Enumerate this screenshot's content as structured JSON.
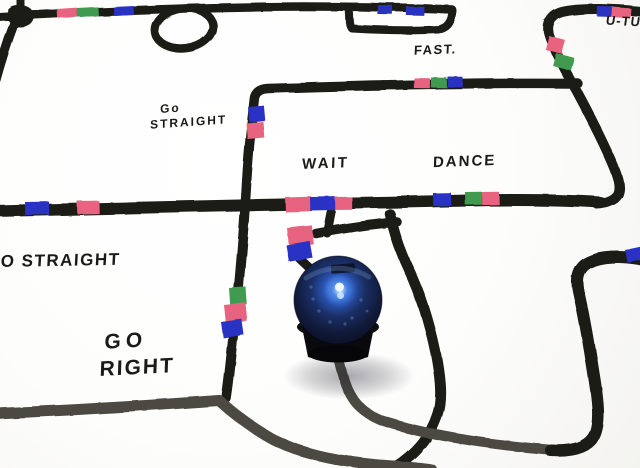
{
  "labels": {
    "go_straight_top_line1": "Go",
    "go_straight_top_line2": "STRAIGHT",
    "fast": "FAST.",
    "u_turn": "U-TURN",
    "wait": "WAIT",
    "dance": "DANCE",
    "go_straight_left": "GO STRAIGHT",
    "go_right_line1": "GO",
    "go_right_line2": "RIGHT"
  },
  "colors": {
    "code_pink": "#e7647f",
    "code_blue": "#2a33c4",
    "code_green": "#419a4f",
    "line_black": "#1b1a18",
    "line_gray": "#4c4a42",
    "robot_led": "#eef6ff",
    "robot_dome_glow": "#2a55b5"
  }
}
